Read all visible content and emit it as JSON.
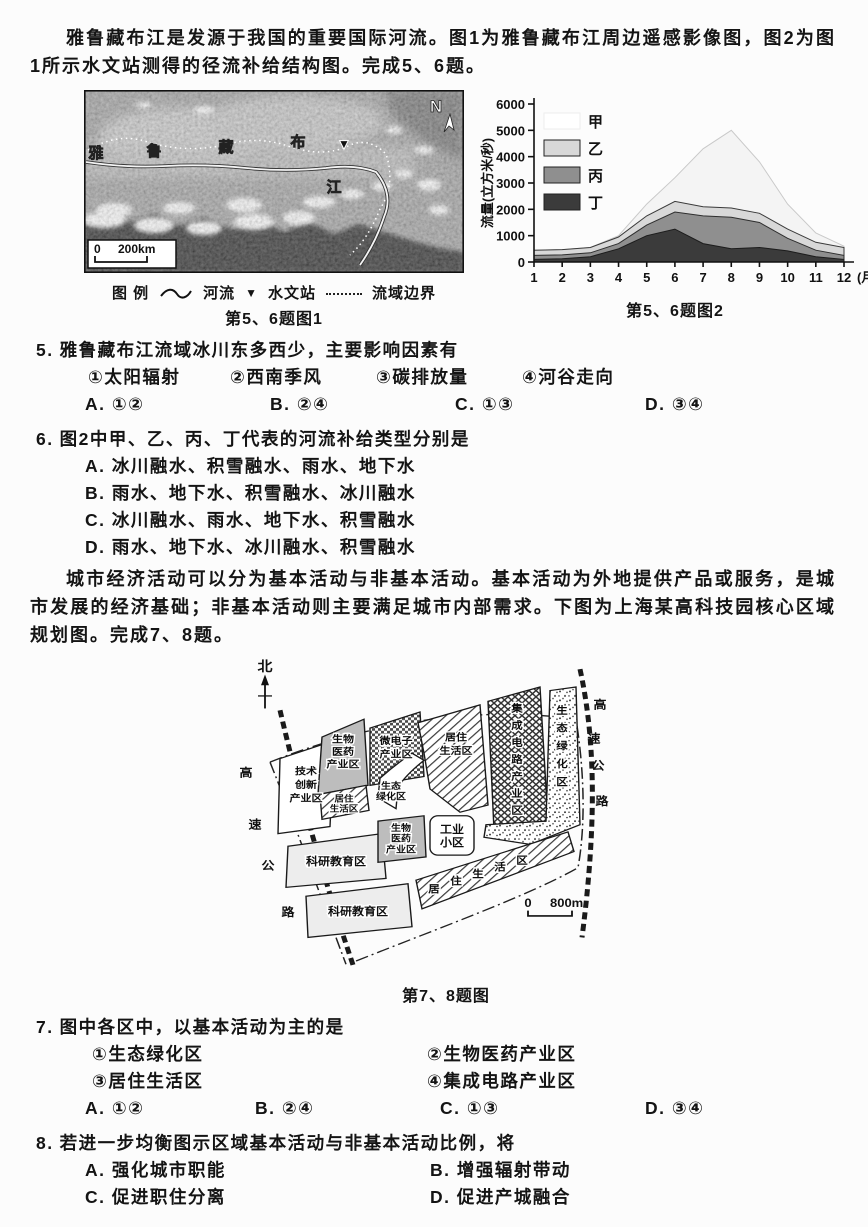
{
  "intro1": "雅鲁藏布江是发源于我国的重要国际河流。图1为雅鲁藏布江周边遥感影像图，图2为图1所示水文站测得的径流补给结构图。完成5、6题。",
  "figure1": {
    "caption": "第5、6题图1",
    "north_label": "N",
    "scale_zero": "0",
    "scale_dist": "200km",
    "river_label_chars": [
      "雅",
      "鲁",
      "藏",
      "布",
      "江"
    ],
    "station_icon": "▼",
    "legend_title": "图 例",
    "legend_river": "河流",
    "legend_station_icon": "▼",
    "legend_station": "水文站",
    "legend_boundary": "流域边界"
  },
  "chart_data": {
    "type": "area",
    "stacked": true,
    "x": [
      1,
      2,
      3,
      4,
      5,
      6,
      7,
      8,
      9,
      10,
      11,
      12
    ],
    "x_unit": "(月)",
    "ylabel": "流量(立方米/秒)",
    "ylim": [
      0,
      6000
    ],
    "ytick_step": 1000,
    "legend_position": "top-left",
    "series": [
      {
        "name": "甲",
        "color": "#f4f4f4",
        "edge": "#c9c9c9",
        "values": [
          0,
          0,
          0,
          50,
          450,
          900,
          2200,
          2950,
          1950,
          950,
          350,
          50
        ]
      },
      {
        "name": "乙",
        "color": "#d8d8d8",
        "edge": "#3a3a3a",
        "values": [
          200,
          200,
          200,
          250,
          350,
          400,
          350,
          350,
          350,
          350,
          300,
          300
        ]
      },
      {
        "name": "丙",
        "color": "#8f8f8f",
        "edge": "#2e2e2e",
        "values": [
          150,
          150,
          150,
          200,
          400,
          650,
          1050,
          1200,
          950,
          480,
          250,
          150
        ]
      },
      {
        "name": "丁",
        "color": "#3b3b3b",
        "edge": "#1c1c1c",
        "values": [
          100,
          120,
          200,
          500,
          1000,
          1250,
          700,
          500,
          550,
          420,
          200,
          100
        ]
      }
    ],
    "caption": "第5、6题图2"
  },
  "q5": {
    "number": "5.",
    "stem": "雅鲁藏布江流域冰川东多西少，主要影响因素有",
    "sub_options": [
      "①太阳辐射",
      "②西南季风",
      "③碳排放量",
      "④河谷走向"
    ],
    "answers": [
      "A. ①②",
      "B. ②④",
      "C. ①③",
      "D. ③④"
    ]
  },
  "q6": {
    "number": "6.",
    "stem": "图2中甲、乙、丙、丁代表的河流补给类型分别是",
    "options": [
      "A. 冰川融水、积雪融水、雨水、地下水",
      "B. 雨水、地下水、积雪融水、冰川融水",
      "C. 冰川融水、雨水、地下水、积雪融水",
      "D. 雨水、地下水、冰川融水、积雪融水"
    ]
  },
  "intro2": "城市经济活动可以分为基本活动与非基本活动。基本活动为外地提供产品或服务，是城市发展的经济基础；非基本活动则主要满足城市内部需求。下图为上海某高科技园核心区域规划图。完成7、8题。",
  "figure3": {
    "caption": "第7、8题图",
    "north_label": "北",
    "scale_zero": "0",
    "scale_dist": "800m",
    "road_chars": [
      "高",
      "速",
      "公",
      "路"
    ],
    "zones": {
      "tech": [
        "技术",
        "创新",
        "产业区"
      ],
      "bio_n": [
        "生物",
        "医药",
        "产业区"
      ],
      "micro": [
        "微电子",
        "产业区"
      ],
      "res_main": [
        "居住",
        "生活区"
      ],
      "ic_chars": [
        "集",
        "成",
        "电",
        "路",
        "产",
        "业",
        "区"
      ],
      "eco_e_chars": [
        "生",
        "态",
        "绿",
        "化",
        "区"
      ],
      "res_small": [
        "居住",
        "生活区"
      ],
      "eco_c": [
        "生态",
        "绿化区"
      ],
      "sci_n": "科研教育区",
      "bio_c": [
        "生物",
        "医药",
        "产业区"
      ],
      "industry": [
        "工业",
        "小区"
      ],
      "sci_s": "科研教育区",
      "res_s_chars": [
        "居",
        "住",
        "生",
        "活",
        "区"
      ]
    }
  },
  "q7": {
    "number": "7.",
    "stem": "图中各区中，以基本活动为主的是",
    "sub_options": [
      "①生态绿化区",
      "②生物医药产业区",
      "③居住生活区",
      "④集成电路产业区"
    ],
    "answers": [
      "A. ①②",
      "B. ②④",
      "C. ①③",
      "D. ③④"
    ]
  },
  "q8": {
    "number": "8.",
    "stem": "若进一步均衡图示区域基本活动与非基本活动比例，将",
    "options": [
      "A. 强化城市职能",
      "B. 增强辐射带动",
      "C. 促进职住分离",
      "D. 促进产城融合"
    ]
  }
}
